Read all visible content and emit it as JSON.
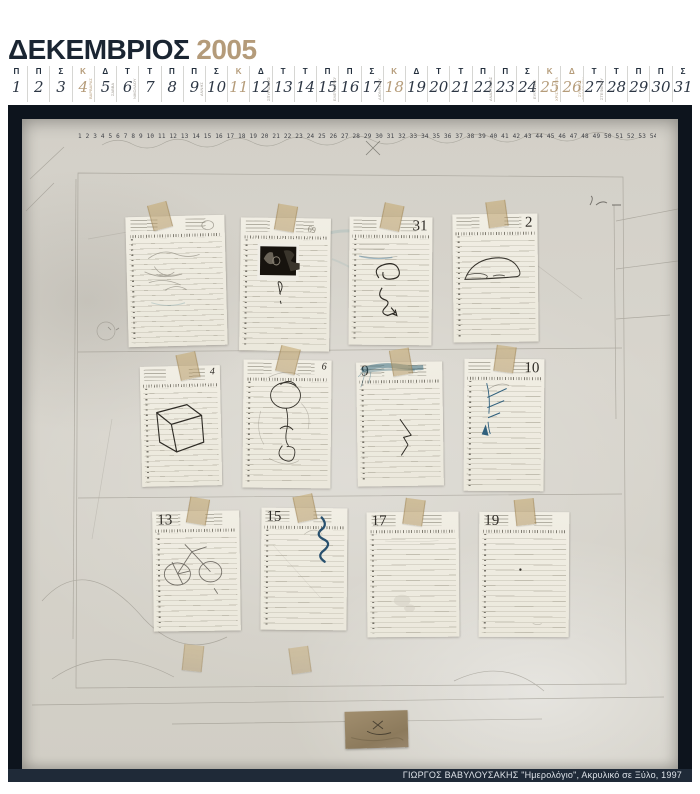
{
  "header": {
    "month": "ΔΕΚΕΜΒΡΙΟΣ",
    "year": "2005"
  },
  "colors": {
    "title_navy": "#1a2532",
    "accent_tan": "#b49b7a",
    "frame": "#0d141d",
    "canvas": "#d4d1c9",
    "paper": "#f0ede3",
    "caption_bar": "#1f2a38",
    "ink_blue": "#2a6076",
    "pencil": "#8d897f"
  },
  "calendar": {
    "days": [
      {
        "n": 1,
        "w": "Π"
      },
      {
        "n": 2,
        "w": "Π"
      },
      {
        "n": 3,
        "w": "Σ"
      },
      {
        "n": 4,
        "w": "Κ",
        "holiday": true,
        "label": "ΒΑΡΒΑΡΑΣ"
      },
      {
        "n": 5,
        "w": "Δ",
        "label": "ΣΑΒΒΑ"
      },
      {
        "n": 6,
        "w": "Τ",
        "label": "ΝΙΚΟΛΑΟΥ"
      },
      {
        "n": 7,
        "w": "Τ"
      },
      {
        "n": 8,
        "w": "Π"
      },
      {
        "n": 9,
        "w": "Π",
        "label": "ΑΝΝΗΣ"
      },
      {
        "n": 10,
        "w": "Σ"
      },
      {
        "n": 11,
        "w": "Κ",
        "holiday": true
      },
      {
        "n": 12,
        "w": "Δ",
        "label": "ΣΠΥΡΙΔΩΝΟΣ"
      },
      {
        "n": 13,
        "w": "Τ"
      },
      {
        "n": 14,
        "w": "Τ"
      },
      {
        "n": 15,
        "w": "Π",
        "label": "ΕΛΕΥΘΕΡΙΟΥ"
      },
      {
        "n": 16,
        "w": "Π"
      },
      {
        "n": 17,
        "w": "Σ",
        "label": "ΔΙΟΝΥΣΙΟΥ"
      },
      {
        "n": 18,
        "w": "Κ",
        "holiday": true
      },
      {
        "n": 19,
        "w": "Δ"
      },
      {
        "n": 20,
        "w": "Τ"
      },
      {
        "n": 21,
        "w": "Τ"
      },
      {
        "n": 22,
        "w": "Π",
        "label": "ΑΝΑΣΤΑΣΙΑΣ"
      },
      {
        "n": 23,
        "w": "Π"
      },
      {
        "n": 24,
        "w": "Σ",
        "label": "ΕΥΓΕΝΙΑΣ"
      },
      {
        "n": 25,
        "w": "Κ",
        "holiday": true,
        "label": "ΧΡΙΣΤΟΥΓΕΝΝΑ"
      },
      {
        "n": 26,
        "w": "Δ",
        "holiday": true,
        "label": "ΣΥΝΑΞΙΣ ΘΕΟΤΟΚΟΥ"
      },
      {
        "n": 27,
        "w": "Τ",
        "label": "ΣΤΕΦΑΝΟΥ"
      },
      {
        "n": 28,
        "w": "Τ"
      },
      {
        "n": 29,
        "w": "Π"
      },
      {
        "n": 30,
        "w": "Π"
      },
      {
        "n": 31,
        "w": "Σ"
      }
    ]
  },
  "painting": {
    "handwritten_numbers": "1 2 3 4 5 6 7 8 9 10 11 12 13 14 15 16 17 18 19 20 21 22 23 24 25 26 27 28 29 30 31 32 33 34 35 36 37 38 39 40 41 42 43 44 45 46 47 48 49 50 51 52 53 54 55",
    "pages": [
      {
        "id": "a",
        "num": "",
        "num_side": "right",
        "num_style": "small",
        "doodle": "cloud",
        "x": 105,
        "y": 97,
        "w": 99,
        "h": 130,
        "rot": -1.5,
        "tape_rot": -15,
        "tape_dx": -18
      },
      {
        "id": "b",
        "num": "",
        "num_side": "right",
        "num_style": "small",
        "doodle": "photo",
        "x": 218,
        "y": 99,
        "w": 90,
        "h": 133,
        "rot": 0.8,
        "tape_rot": 10,
        "tape_dx": 0
      },
      {
        "id": "c",
        "num": "31",
        "num_side": "right",
        "num_style": "big",
        "doodle": "spiral",
        "x": 327,
        "y": 98,
        "w": 83,
        "h": 128,
        "rot": 0.5,
        "tape_rot": 12,
        "tape_dx": 0
      },
      {
        "id": "d",
        "num": "2",
        "num_side": "right",
        "num_style": "big",
        "doodle": "mouse",
        "x": 431,
        "y": 95,
        "w": 85,
        "h": 128,
        "rot": -0.6,
        "tape_rot": -8,
        "tape_dx": 0
      },
      {
        "id": "e",
        "num": "4",
        "num_side": "right",
        "num_style": "small",
        "doodle": "cube",
        "x": 119,
        "y": 247,
        "w": 80,
        "h": 120,
        "rot": -1.2,
        "tape_rot": -12,
        "tape_dx": 6
      },
      {
        "id": "f",
        "num": "6",
        "num_side": "right",
        "num_style": "small",
        "doodle": "figure",
        "x": 221,
        "y": 241,
        "w": 88,
        "h": 128,
        "rot": 0.6,
        "tape_rot": 14,
        "tape_dx": 0
      },
      {
        "id": "g",
        "num": "9",
        "num_side": "left",
        "num_style": "big",
        "doodle": "smear",
        "x": 335,
        "y": 243,
        "w": 86,
        "h": 124,
        "rot": -0.8,
        "tape_rot": -10,
        "tape_dx": 0
      },
      {
        "id": "h",
        "num": "10",
        "num_side": "right",
        "num_style": "big",
        "doodle": "bluescribble",
        "x": 442,
        "y": 240,
        "w": 80,
        "h": 132,
        "rot": 0.4,
        "tape_rot": 8,
        "tape_dx": 0
      },
      {
        "id": "i",
        "num": "13",
        "num_side": "left",
        "num_style": "big",
        "doodle": "bicycle",
        "x": 131,
        "y": 392,
        "w": 87,
        "h": 120,
        "rot": -0.8,
        "tape_rot": 10,
        "tape_dx": 0
      },
      {
        "id": "j",
        "num": "15",
        "num_side": "left",
        "num_style": "big",
        "doodle": "zigzag",
        "x": 239,
        "y": 389,
        "w": 86,
        "h": 122,
        "rot": 0.5,
        "tape_rot": -12,
        "tape_dx": 0
      },
      {
        "id": "k",
        "num": "17",
        "num_side": "left",
        "num_style": "big",
        "doodle": "blank17",
        "x": 345,
        "y": 393,
        "w": 92,
        "h": 125,
        "rot": -0.4,
        "tape_rot": 8,
        "tape_dx": 0
      },
      {
        "id": "l",
        "num": "19",
        "num_side": "left",
        "num_style": "big",
        "doodle": "blank19",
        "x": 457,
        "y": 393,
        "w": 90,
        "h": 125,
        "rot": 0.3,
        "tape_rot": -6,
        "tape_dx": 0
      }
    ],
    "stray_tapes": [
      {
        "x": 161,
        "y": 526,
        "rot": 6
      },
      {
        "x": 268,
        "y": 528,
        "rot": -8
      }
    ],
    "caption": "ΓΙΩΡΓΟΣ ΒΑΒΥΛΟΥΣΑΚΗΣ \"Ημερολόγιο\", Ακρυλικό σε Ξύλο, 1997",
    "caption_artist": "ΓΙΩΡΓΟΣ ΒΑΒΥΛΟΥΣΑΚΗΣ",
    "caption_work": "Ημερολόγιο",
    "caption_medium": "Ακρυλικό σε Ξύλο",
    "caption_year": "1997"
  }
}
